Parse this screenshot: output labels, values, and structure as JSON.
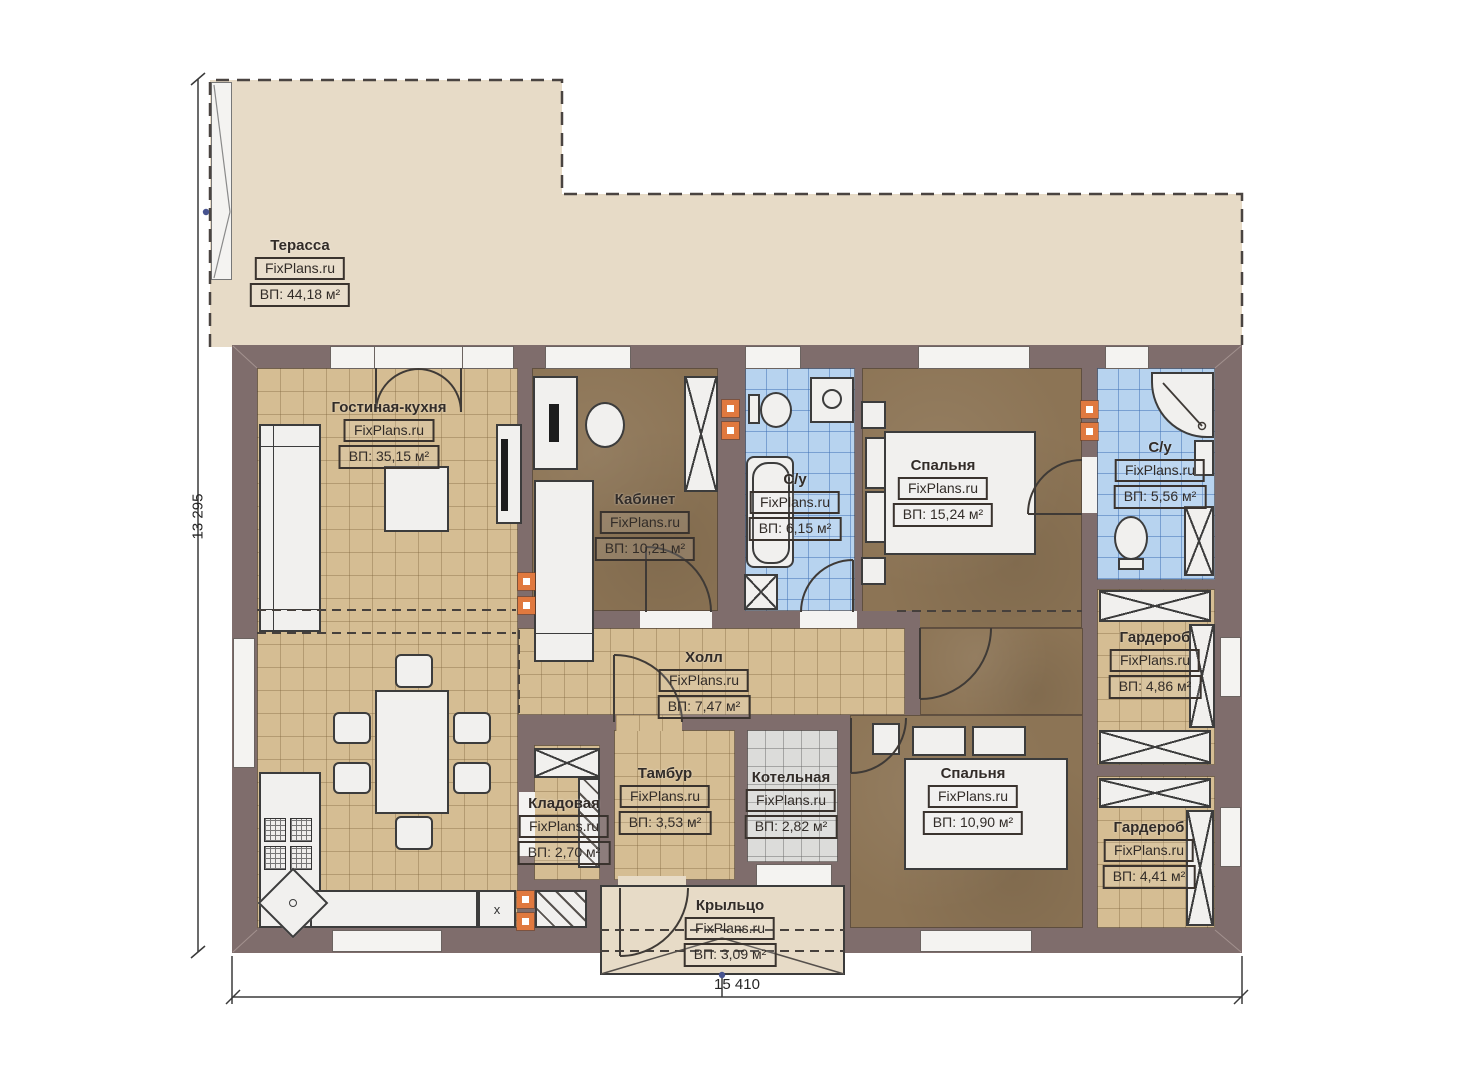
{
  "watermark": "FixPlans.ru",
  "dimensions": {
    "width": "15 410",
    "height": "13 295"
  },
  "marks": {
    "kitchen_x": "x"
  },
  "colors": {
    "wall": "#7f6d6c",
    "terrace_floor": "#e7dbc7",
    "tile_tan": "#d5bd93",
    "tile_blue": "#b7d3ef",
    "tile_gray": "#dcdcda",
    "floor_brown": "#8c7455",
    "furniture": "#f1f0ee",
    "accent_orange": "#e0793f",
    "line": "#3c3c3c"
  },
  "rooms": {
    "terrace": {
      "name": "Терасса",
      "area": "ВП: 44,18 м²"
    },
    "living": {
      "name": "Гостиная-кухня",
      "area": "ВП: 35,15 м²"
    },
    "office": {
      "name": "Кабинет",
      "area": "ВП: 10,21 м²"
    },
    "bath1": {
      "name": "С/у",
      "area": "ВП: 6,15 м²"
    },
    "bedroom1": {
      "name": "Спальня",
      "area": "ВП: 15,24 м²"
    },
    "bath2": {
      "name": "С/у",
      "area": "ВП: 5,56 м²"
    },
    "wardrobe1": {
      "name": "Гардероб",
      "area": "ВП: 4,86 м²"
    },
    "hall": {
      "name": "Холл",
      "area": "ВП: 7,47 м²"
    },
    "tambour": {
      "name": "Тамбур",
      "area": "ВП: 3,53 м²"
    },
    "boiler": {
      "name": "Котельная",
      "area": "ВП: 2,82 м²"
    },
    "bedroom2": {
      "name": "Спальня",
      "area": "ВП: 10,90 м²"
    },
    "pantry": {
      "name": "Кладовая",
      "area": "ВП: 2,70 м²"
    },
    "wardrobe2": {
      "name": "Гардероб",
      "area": "ВП: 4,41 м²"
    },
    "porch": {
      "name": "Крыльцо",
      "area": "ВП: 3,09 м²"
    }
  }
}
